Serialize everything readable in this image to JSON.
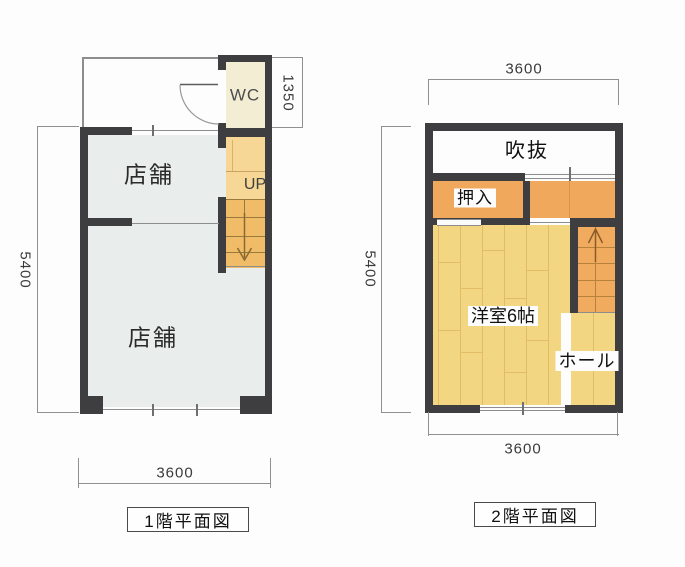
{
  "floor1": {
    "title": "1階平面図",
    "shop_upper": "店舗",
    "shop_lower": "店舗",
    "wc": "WC",
    "stair_direction": "UP",
    "dim_height": "5400",
    "dim_width": "3600",
    "dim_wc_depth": "1350"
  },
  "floor2": {
    "title": "2階平面図",
    "void_room": "吹抜",
    "closet": "押入",
    "western_room": "洋室6帖",
    "hall": "ホール",
    "dim_height": "5400",
    "dim_width_top": "3600",
    "dim_width_bottom": "3600"
  },
  "colors": {
    "wall": "#3e3e40",
    "shop_fill": "#e9edec",
    "wc_fill": "#f2edd3",
    "stair_upper_fill": "#f6d795",
    "stair_tread_fill": "#f1bc67",
    "orange_fill": "#f0a95c",
    "wood_fill": "#f3d682",
    "void_fill": "#fdfdfd",
    "line": "#8d8d8d"
  }
}
